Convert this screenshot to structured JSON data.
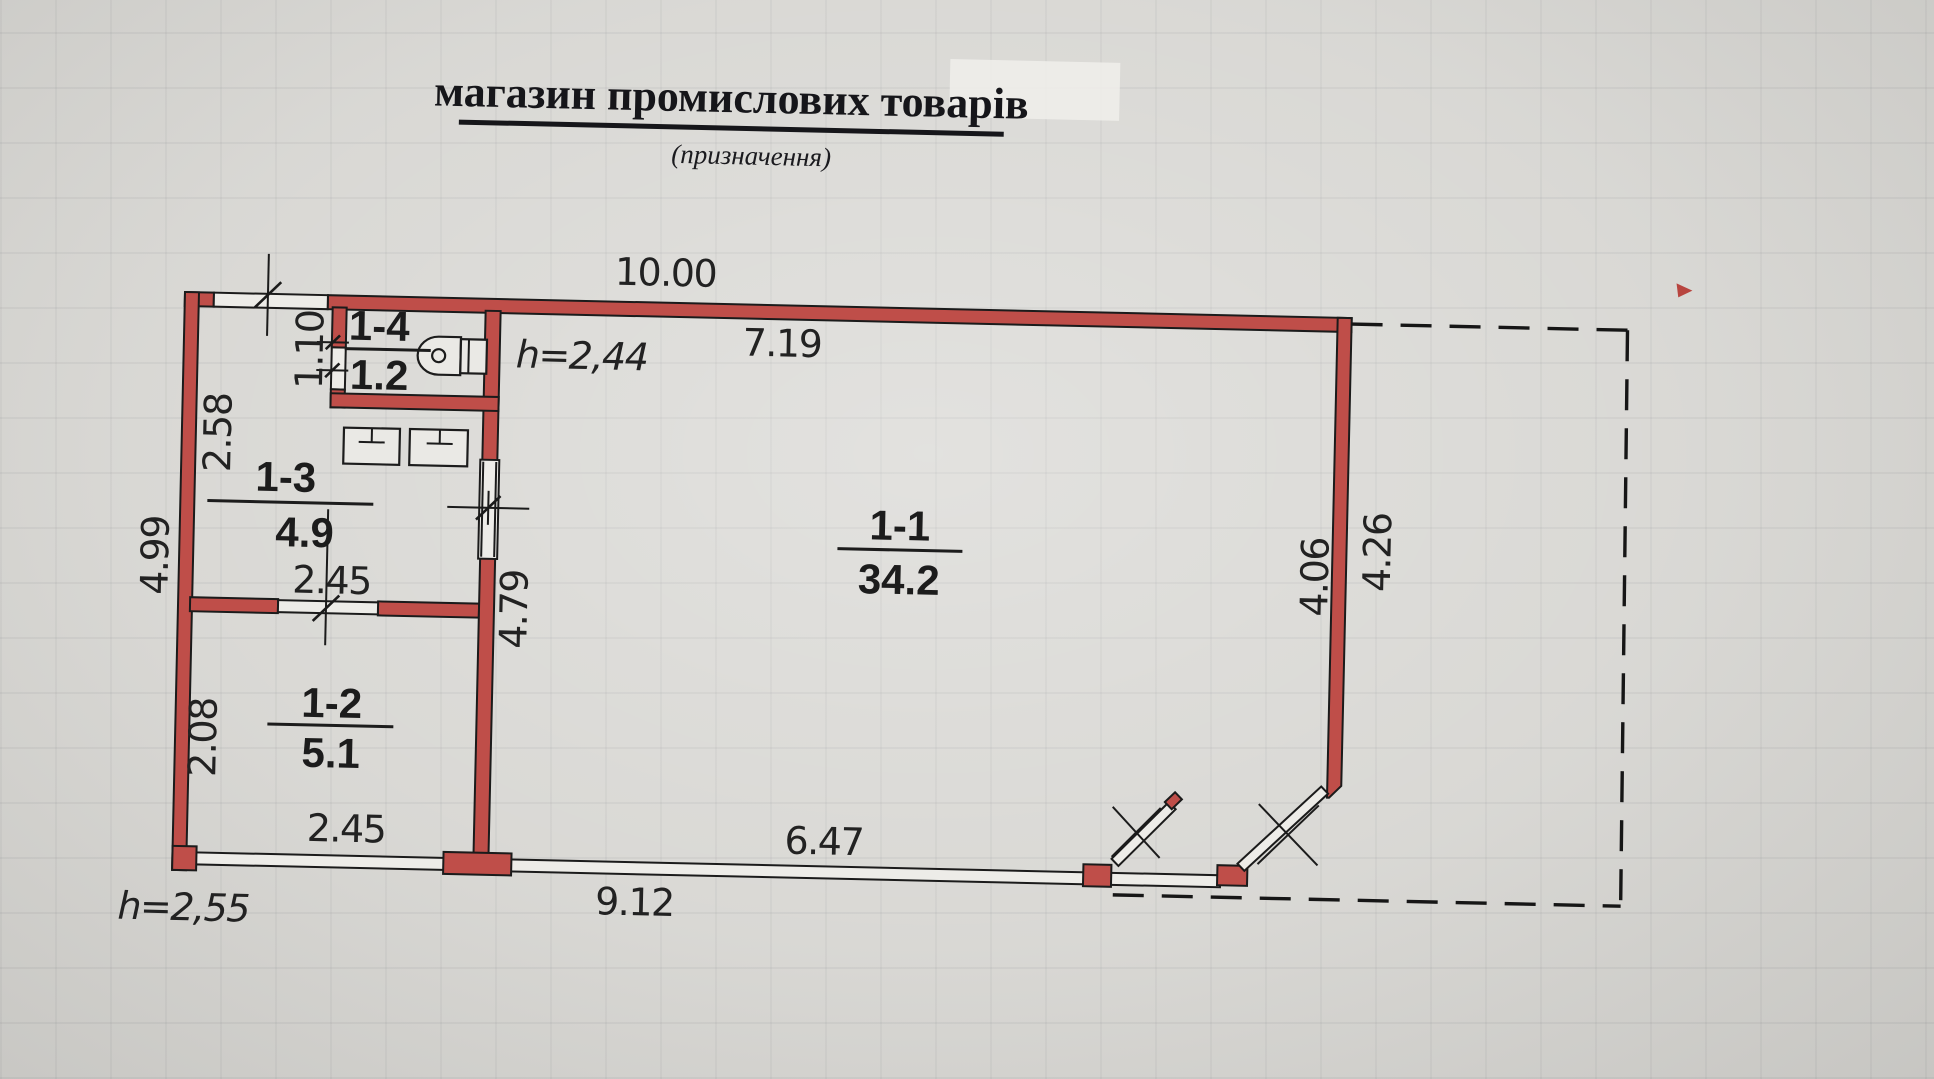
{
  "title": {
    "main": "магазин промислових товарів",
    "subtitle": "(призначення)"
  },
  "rooms": {
    "r11": {
      "id": "1-1",
      "area": "34.2"
    },
    "r12": {
      "id": "1-2",
      "area": "5.1"
    },
    "r13": {
      "id": "1-3",
      "area": "4.9"
    },
    "r14": {
      "id": "1-4",
      "area": "1.2"
    }
  },
  "dims": {
    "top_total": "10.00",
    "hall_top": "7.19",
    "hall_height_note": "h=2,44",
    "left_total": "4.99",
    "r13_left": "2.58",
    "r12_left": "2.08",
    "r14_left": "1.10",
    "r13_width": "2.45",
    "hall_left": "4.79",
    "right_inner": "4.06",
    "right_outer": "4.26",
    "r12_bottom": "2.45",
    "hall_bottom": "6.47",
    "bottom_total": "9.12",
    "left_height_note": "h=2,55"
  },
  "icons": {
    "toilet": "toilet-icon",
    "washbasin": "washbasin-icon"
  },
  "colors": {
    "wall": "#bf4e49",
    "paper": "#d6d5d1",
    "ink": "#1b1b1b"
  }
}
